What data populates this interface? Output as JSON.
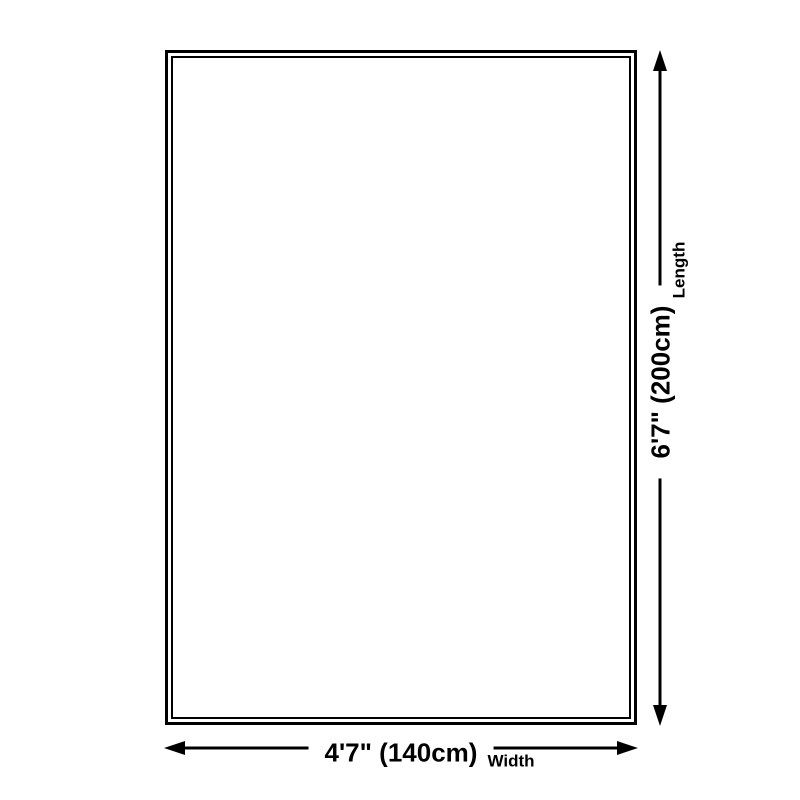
{
  "colors": {
    "ink": "#000000",
    "background": "#ffffff"
  },
  "diagram": {
    "width": {
      "value": "4'7\" (140cm)",
      "caption": "Width"
    },
    "length": {
      "value": "6'7\" (200cm)",
      "caption": "Length"
    }
  }
}
